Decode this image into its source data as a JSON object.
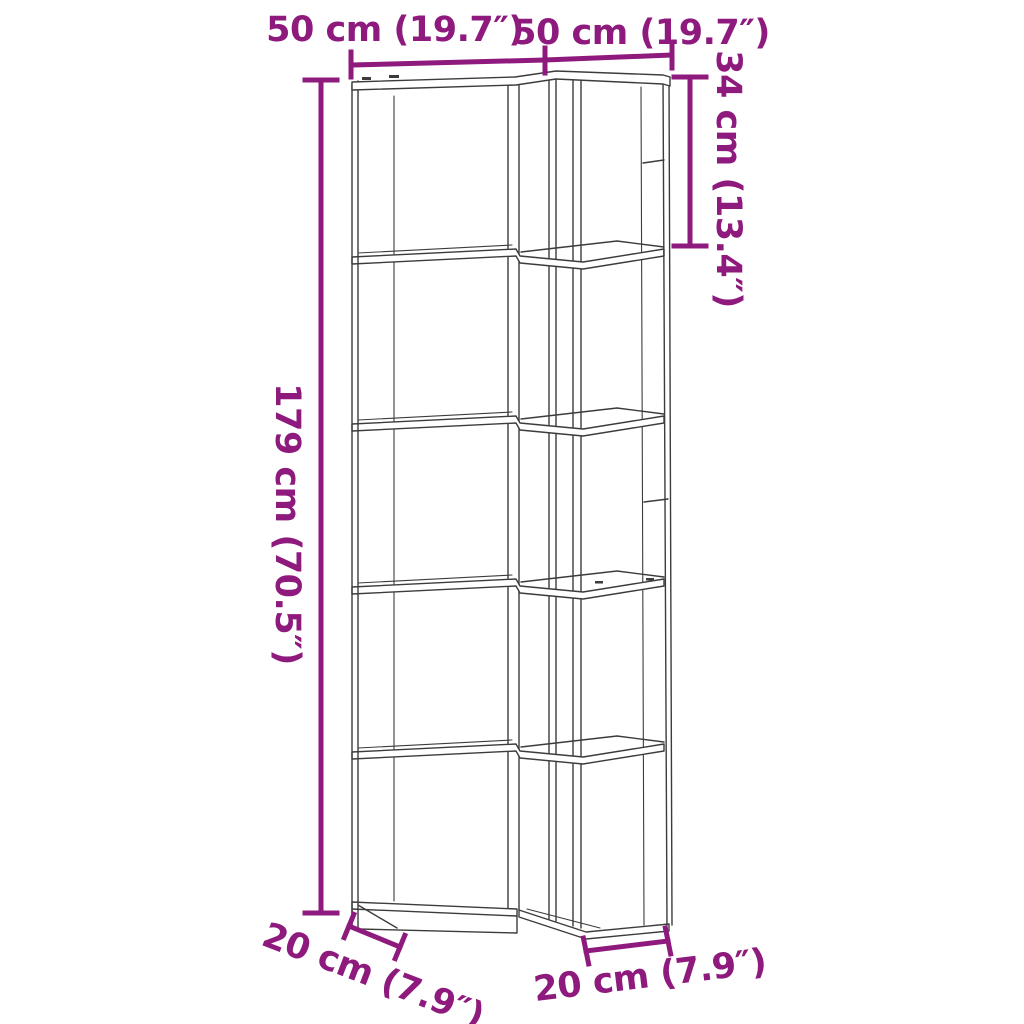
{
  "figure": {
    "colors": {
      "dimension": "#8E1A7D",
      "outline": "#3C3C3B",
      "background": "#FFFFFF"
    },
    "shelf": {
      "tiers": 5
    },
    "dimensions": {
      "top_left_width": "50 cm (19.7″)",
      "top_right_width": "50 cm (19.7″)",
      "height": "179 cm (70.5″)",
      "top_tier_height": "34 cm (13.4″)",
      "bottom_left_depth": "20 cm (7.9″)",
      "bottom_right_depth": "20 cm (7.9″)"
    }
  }
}
